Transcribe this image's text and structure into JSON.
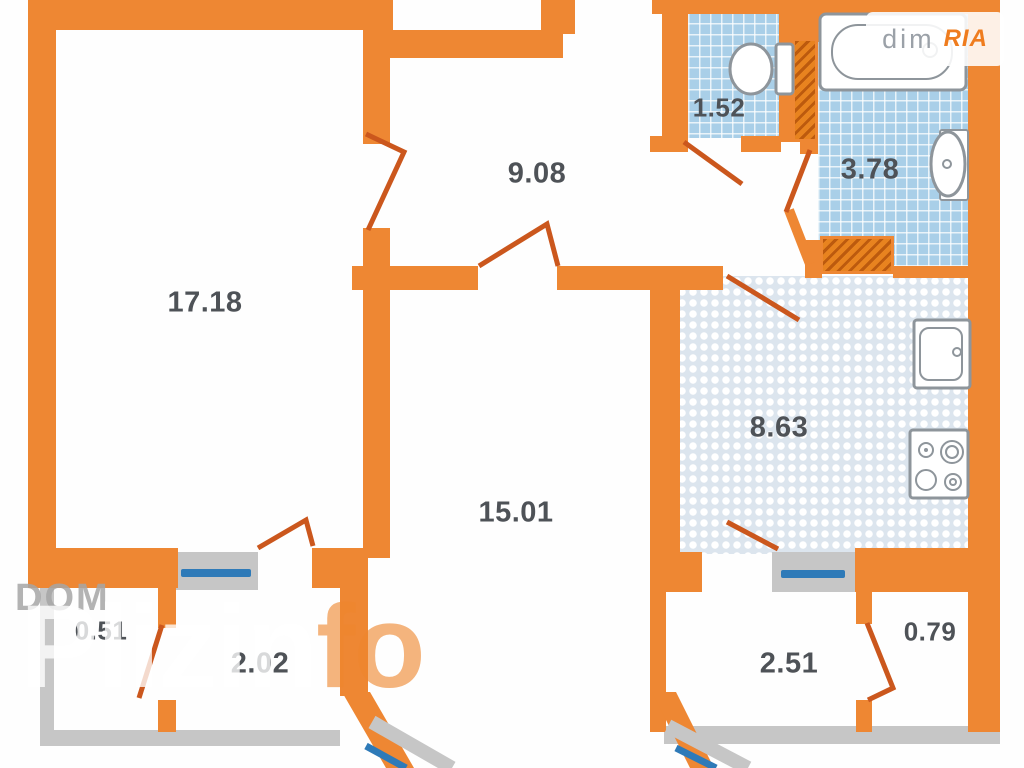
{
  "plan": {
    "rooms": [
      {
        "id": "living-room",
        "area": "17.18"
      },
      {
        "id": "hallway",
        "area": "9.08"
      },
      {
        "id": "wc",
        "area": "1.52"
      },
      {
        "id": "bathroom",
        "area": "3.78"
      },
      {
        "id": "kitchen",
        "area": "8.63"
      },
      {
        "id": "bedroom",
        "area": "15.01"
      },
      {
        "id": "balcony-left",
        "area": "0.51"
      },
      {
        "id": "loggia-left",
        "area": "2.02"
      },
      {
        "id": "loggia-right",
        "area": "2.51"
      },
      {
        "id": "balcony-right",
        "area": "0.79"
      }
    ],
    "fixtures": [
      "bathtub",
      "toilet",
      "washbasin",
      "kitchen-sink",
      "stove"
    ],
    "colors": {
      "wall": "#EE8733",
      "door": "#CB571D",
      "tile": "#A9CFE8",
      "kitchen_tile": "#DCE5EE",
      "window": "#2E7AB8",
      "balcony_wall": "#C6C6C6",
      "label": "#4E5257"
    }
  },
  "watermarks": {
    "dom": "DOM",
    "pliz": "Pliz",
    "info_white": "in",
    "info_orange": "fo",
    "logo_text": "dim",
    "logo_brand": "RIA"
  }
}
